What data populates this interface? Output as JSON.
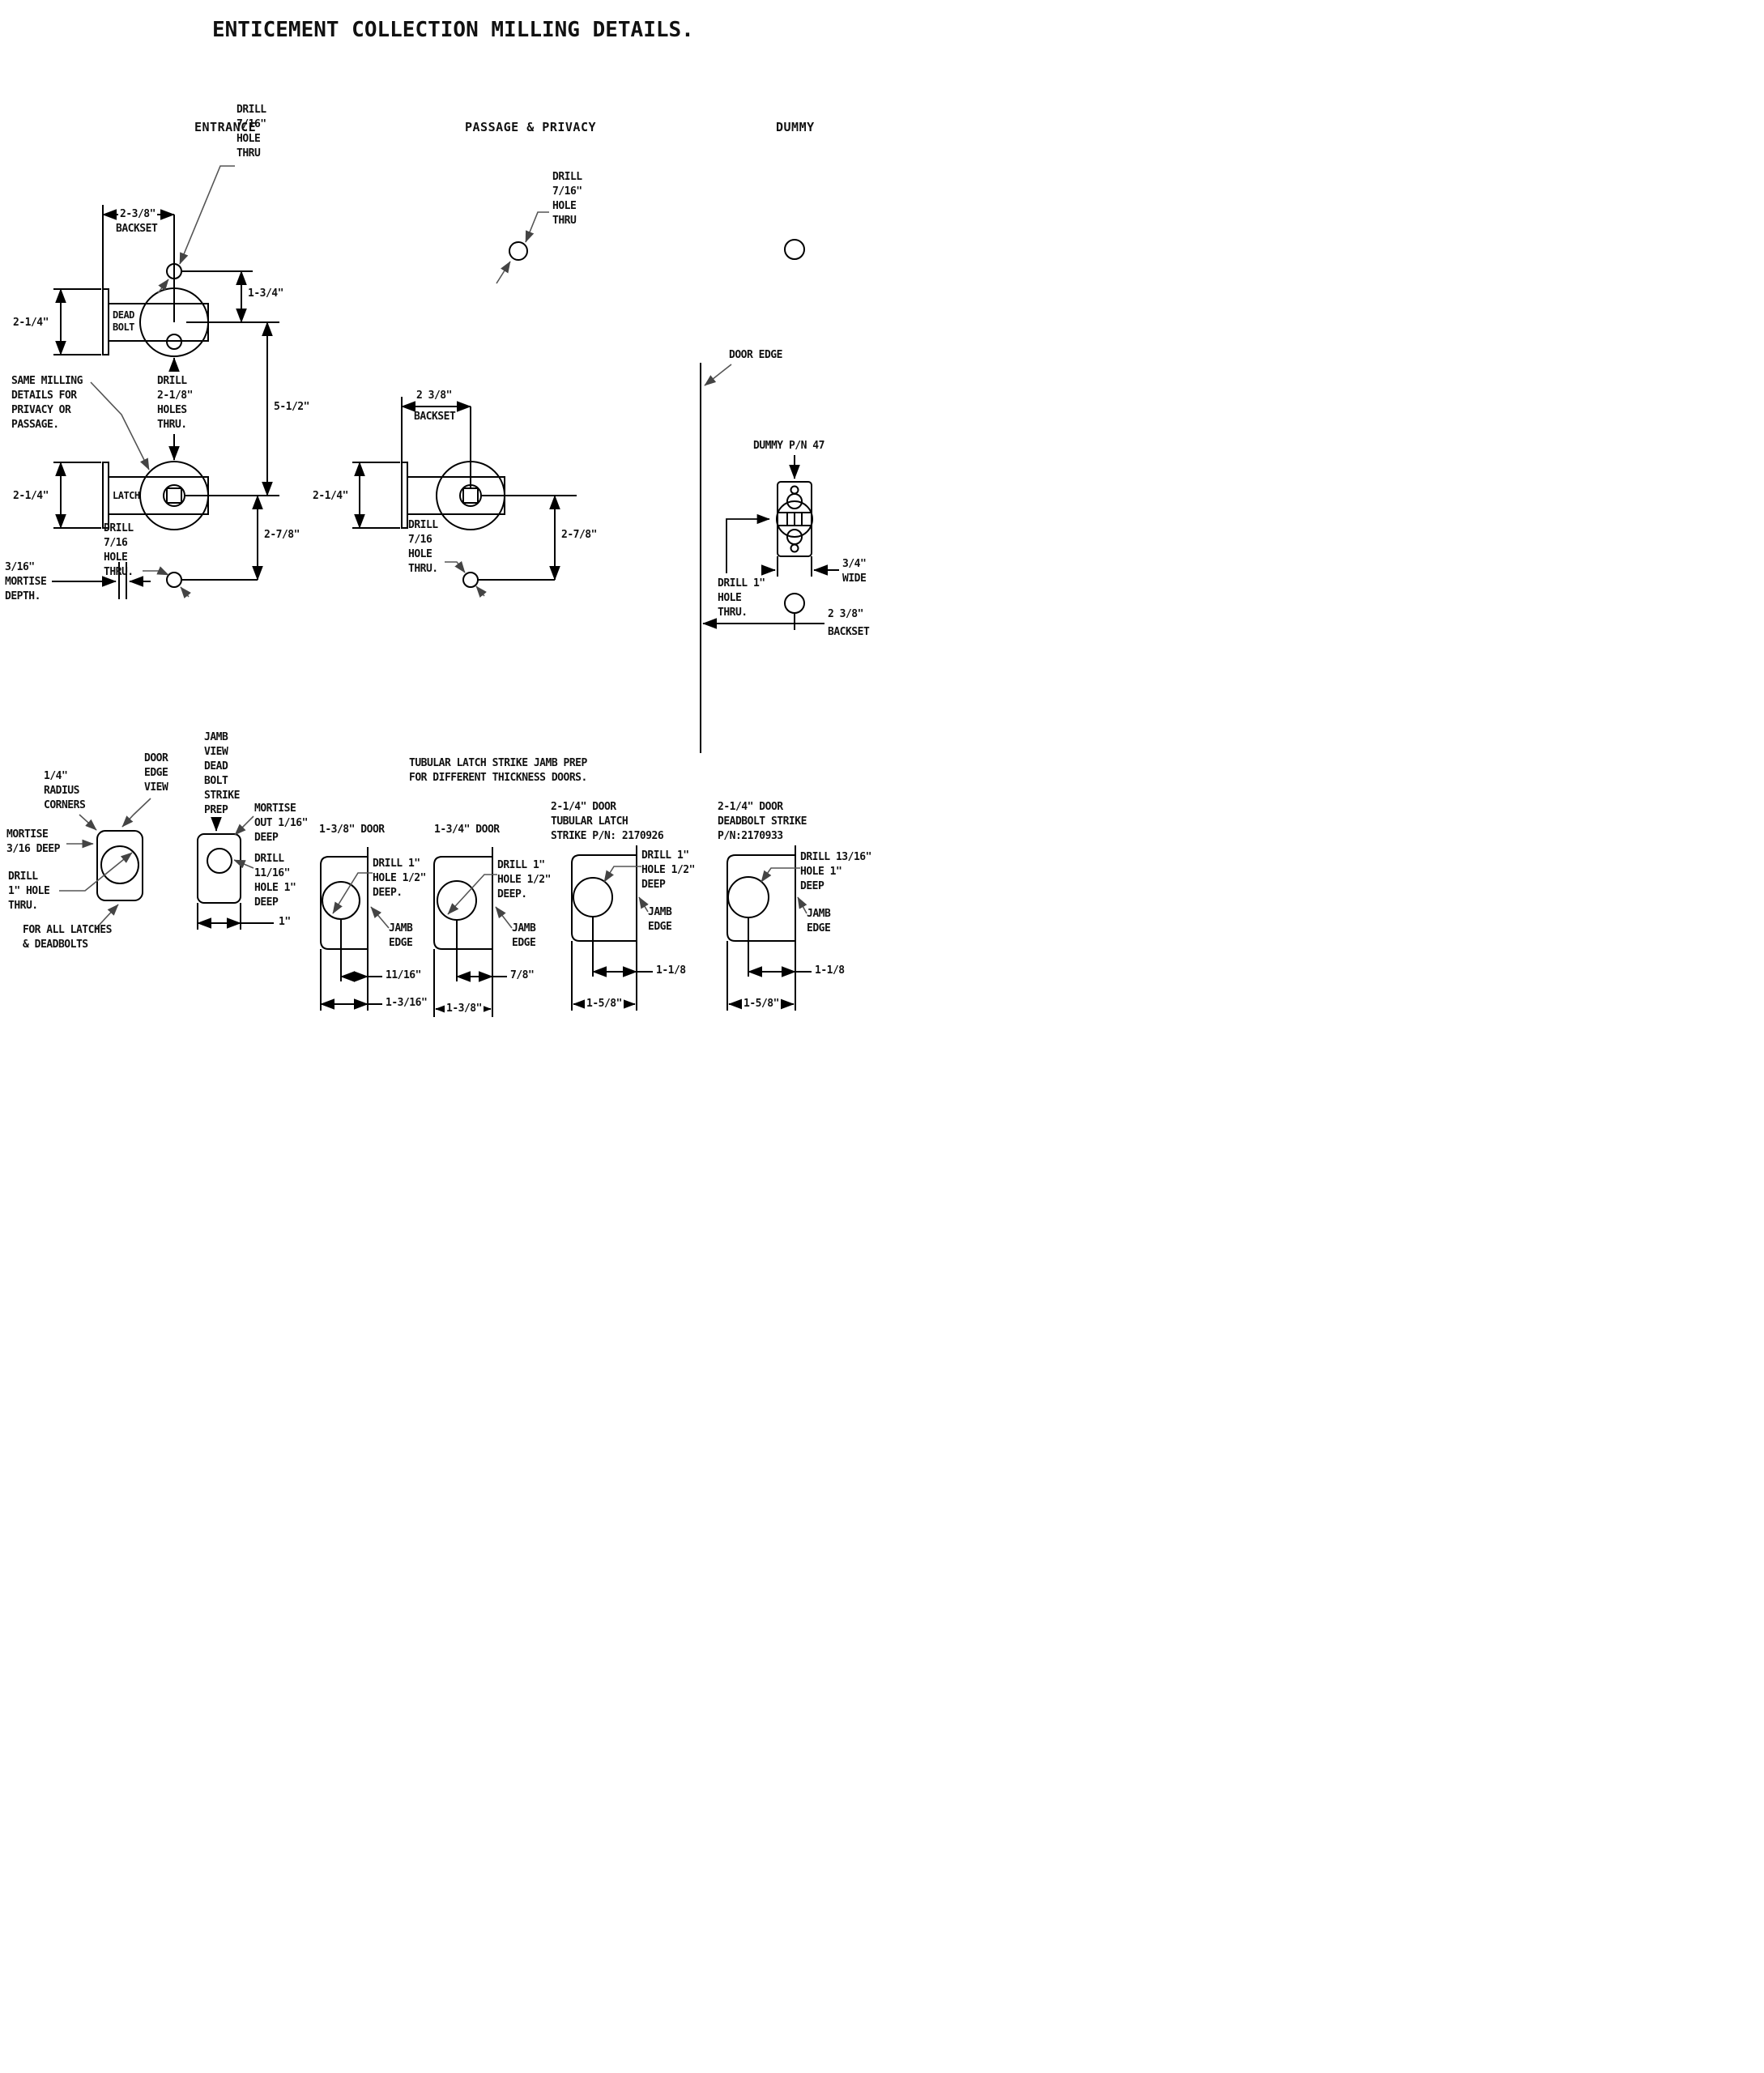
{
  "title": "ENTICEMENT COLLECTION MILLING DETAILS.",
  "colors": {
    "background": "#ffffff",
    "line": "#000000",
    "leader": "#555555",
    "text": "#111111"
  },
  "sections": {
    "entrance": {
      "heading": "ENTRANCE",
      "backset_value": "2-3/8\"",
      "backset_label": "BACKSET",
      "drill_716_top": "DRILL\n7/16\"\nHOLE\nTHRU",
      "dim_134": "1-3/4\"",
      "dim_214_deadbolt": "2-1/4\"",
      "deadbolt_label": "DEAD\nBOLT",
      "drill_218": "DRILL\n2-1/8\"\nHOLES\nTHRU.",
      "dim_512": "5-1/2\"",
      "same_milling": "SAME MILLING\nDETAILS FOR\nPRIVACY OR\nPASSAGE.",
      "dim_214_latch": "2-1/4\"",
      "latch_label": "LATCH",
      "mortise_depth": "3/16\"\nMORTISE\nDEPTH.",
      "drill_716_bottom": "DRILL\n7/16\nHOLE\nTHRU.",
      "dim_278": "2-7/8\""
    },
    "passage": {
      "heading": "PASSAGE & PRIVACY",
      "drill_716_top": "DRILL\n7/16\"\nHOLE\nTHRU",
      "backset_value": "2 3/8\"",
      "backset_label": "BACKSET",
      "dim_214": "2-1/4\"",
      "dim_278": "2-7/8\"",
      "drill_716_bottom": "DRILL\n7/16\nHOLE\nTHRU."
    },
    "dummy": {
      "heading": "DUMMY",
      "door_edge": "DOOR EDGE",
      "pn": "DUMMY P/N 47",
      "width": "3/4\"\nWIDE",
      "drill_1": "DRILL 1\"\nHOLE\nTHRU.",
      "backset_value": "2 3/8\"",
      "backset_label": "BACKSET"
    },
    "bottom": {
      "strike_heading": "TUBULAR LATCH STRIKE JAMB PREP\nFOR DIFFERENT THICKNESS DOORS.",
      "door_edge_view": {
        "radius": "1/4\"\nRADIUS\nCORNERS",
        "view": "DOOR\nEDGE\nVIEW",
        "mortise": "MORTISE\n3/16 DEEP",
        "drill": "DRILL\n1\" HOLE\nTHRU.",
        "for_all": "FOR ALL LATCHES\n& DEADBOLTS"
      },
      "jamb_view": {
        "title": "JAMB\nVIEW\nDEAD\nBOLT\nSTRIKE\nPREP",
        "mortise": "MORTISE\nOUT 1/16\"\nDEEP",
        "drill": "DRILL\n11/16\"\nHOLE 1\"\nDEEP",
        "width": "1\""
      },
      "door_138": {
        "title": "1-3/8\" DOOR",
        "drill": "DRILL 1\"\nHOLE 1/2\"\nDEEP.",
        "jamb_edge": "JAMB\nEDGE",
        "dim_center": "11/16\"",
        "dim_total": "1-3/16\""
      },
      "door_134": {
        "title": "1-3/4\" DOOR",
        "drill": "DRILL 1\"\nHOLE 1/2\"\nDEEP.",
        "jamb_edge": "JAMB\nEDGE",
        "dim_center": "7/8\"",
        "dim_total": "1-3/8\""
      },
      "door_214_latch": {
        "title": "2-1/4\" DOOR\nTUBULAR LATCH\nSTRIKE P/N: 2170926",
        "drill": "DRILL 1\"\nHOLE 1/2\"\nDEEP",
        "jamb_edge": "JAMB\nEDGE",
        "dim_center": "1-1/8",
        "dim_total": "1-5/8\""
      },
      "door_214_deadbolt": {
        "title": "2-1/4\" DOOR\nDEADBOLT STRIKE\nP/N:2170933",
        "drill": "DRILL 13/16\"\nHOLE 1\"\nDEEP",
        "jamb_edge": "JAMB\nEDGE",
        "dim_center": "1-1/8",
        "dim_total": "1-5/8\""
      }
    }
  }
}
